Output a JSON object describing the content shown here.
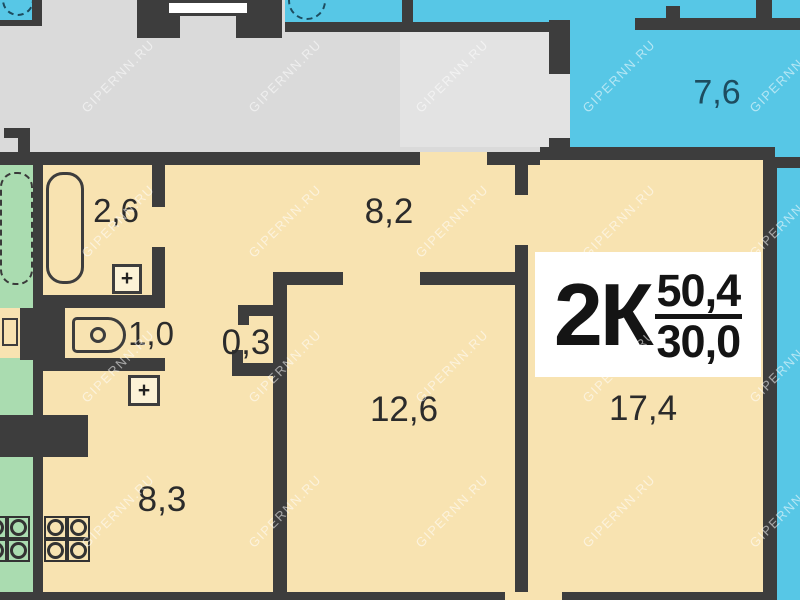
{
  "plan": {
    "watermark": "GIPERNN.RU",
    "summary": {
      "rooms_label": "2К",
      "total_area": "50,4",
      "living_area": "30,0"
    },
    "rooms": {
      "bathroom": "2,6",
      "hallway": "8,2",
      "wc": "1,0",
      "closet": "0,3",
      "bedroom": "12,6",
      "living_room": "17,4",
      "kitchen": "8,3",
      "neighbor_room": "7,6"
    },
    "symbols": {
      "plus": "+"
    },
    "colors": {
      "walls": "#3d3d3d",
      "apartment_fill": "#f8e3b1",
      "corridor_fill": "#dadada",
      "neighbor_blue_fill": "#57c7e6",
      "neighbor_green_fill": "#aadcb0",
      "label_text": "#2b2b2b",
      "blue_label_text": "#1d4c5f",
      "summary_box": "#ffffff"
    }
  }
}
